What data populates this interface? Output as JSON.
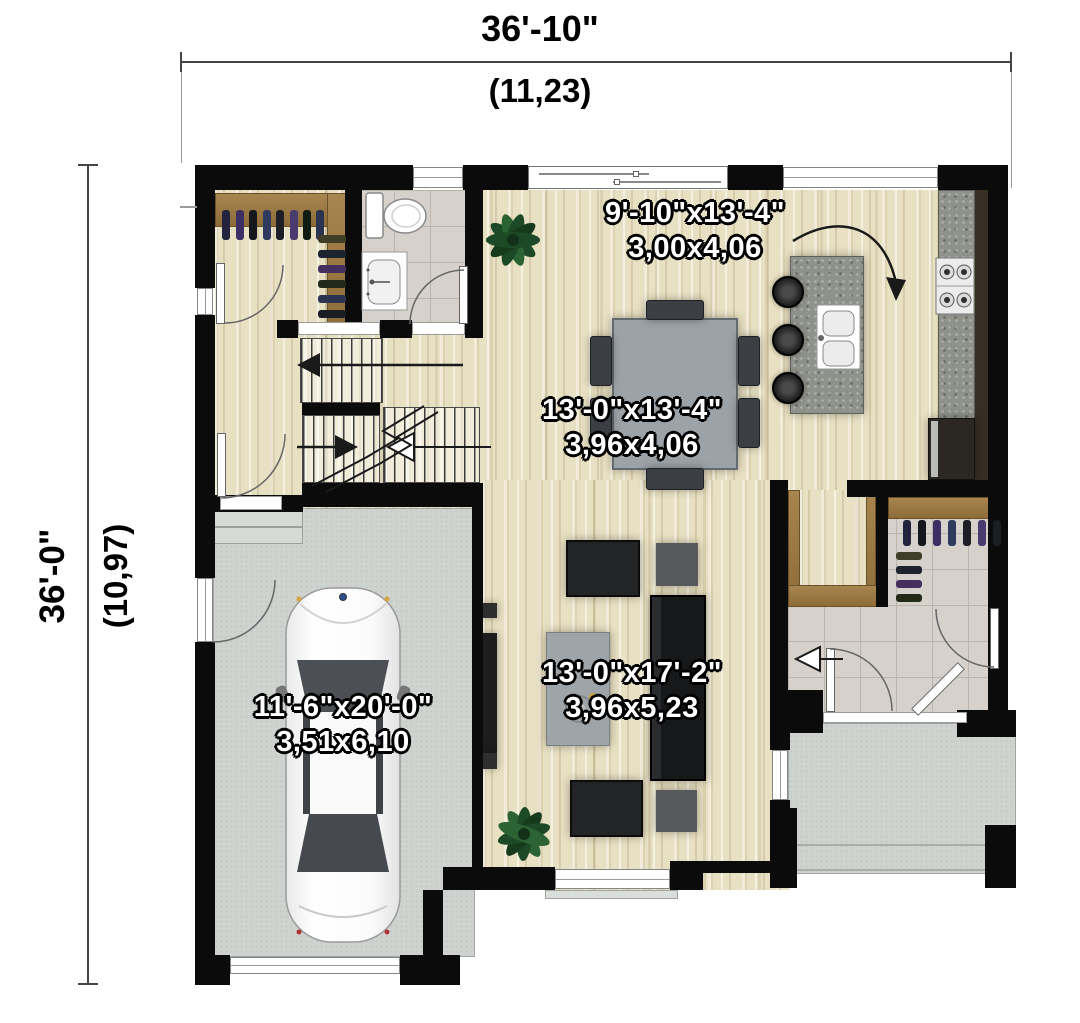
{
  "plan": {
    "title": "first-floor-plan",
    "dimensions": {
      "top": {
        "imperial": "36'-10\"",
        "metric": "(11,23)"
      },
      "left": {
        "imperial": "36'-0\"",
        "metric": "(10,97)"
      }
    },
    "rooms": [
      {
        "name": "kitchen",
        "imperial": "9'-10\"x13'-4\"",
        "metric": "3,00x4,06"
      },
      {
        "name": "dining",
        "imperial": "13'-0\"x13'-4\"",
        "metric": "3,96x4,06"
      },
      {
        "name": "living-room",
        "imperial": "13'-0\"x17'-2\"",
        "metric": "3,96x5,23"
      },
      {
        "name": "garage",
        "imperial": "11'-6\"x20'-0\"",
        "metric": "3,51x6,10"
      }
    ],
    "colors": {
      "wall": "#0b0b0b",
      "wood_floor": "#e8e0c2",
      "tile_floor": "#d6d2cb",
      "concrete": "#cfd3cf",
      "shelf_wood": "#9b7a45",
      "granite": "#8f928b",
      "label_text": "#ffffff",
      "dimension_text": "#000000"
    }
  }
}
